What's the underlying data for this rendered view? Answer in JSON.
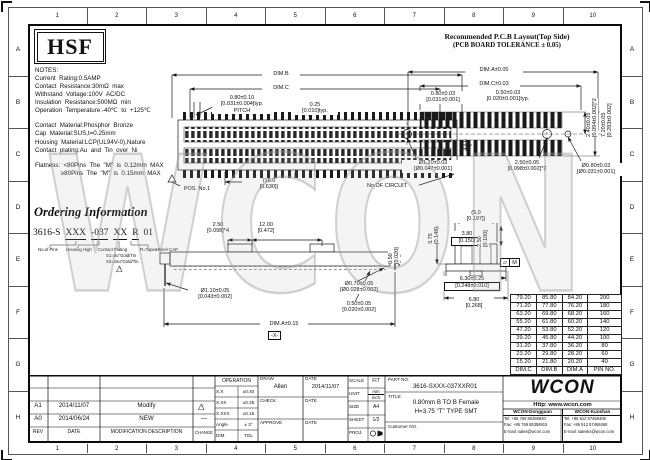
{
  "frame": {
    "cols": [
      "1",
      "2",
      "3",
      "4",
      "5",
      "6",
      "7",
      "8",
      "9",
      "10"
    ],
    "rows": [
      "A",
      "B",
      "C",
      "D",
      "E",
      "F",
      "G",
      "H"
    ]
  },
  "hsf_logo": "HSF",
  "notes": {
    "lines": [
      "NOTES:",
      "Current  Rating:0.5AMP",
      "Contact  Resistance:30mΩ  max",
      "Withstand  Voltage:100V  AC/DC",
      "Insulation  Resistance:500MΩ  min",
      "Operation  Temperature:-40℃  to  +125℃",
      "",
      "Contact  Material:Phosphor  Bronze",
      "Cap  Material:SUS,t=0.25mm",
      "Housing  Material:LCP(UL94V-0),Nature",
      "Contact  plating:Au  and  Tin  over  Ni",
      "",
      "Flatness:  <80Pins  The  \"M\"  is  0.12mm  MAX",
      "               ≥80Pins  The  \"M\"  is  0.15mm  MAX"
    ]
  },
  "pcb": {
    "title": "Recommended P.C.B Layout(Top Side)",
    "subtitle": "(PCB BOARD TOLERANCE ± 0.05)",
    "dim_a": "DIM.A±0.05",
    "dim_c": "DIM.C±0.03",
    "pitch_mm": "0.80±0.03",
    "pitch_in": "[0.031±0.001]",
    "pad_mm": "0.50±0.03",
    "pad_in": "[0.020±0.001]typ.",
    "row_mm": "2.40±0.05",
    "row_in": "[0.094±0.002]*2",
    "span_mm": "7.20±0.05",
    "span_in": "[0.283±0.002]",
    "hole_left_mm": "Ø1.20±0.03",
    "hole_left_in": "[Ø0.047±0.001]",
    "hole_pitch_mm": "2.50±0.05",
    "hole_pitch_in": "[0.098±0.002]*2",
    "hole_right_mm": "Ø0.80±0.03",
    "hole_right_in": "[Ø0.031±0.001]"
  },
  "topview": {
    "dim_b": "DIM.B",
    "dim_c": "DIM.C",
    "pitch_mm": "0.80±0.10",
    "pitch_in": "[0.031±0.004]typ.",
    "pitch_word": "PITCH",
    "tab_mm": "0.25",
    "tab_in": "[0.010]typ.",
    "len_mm": "(16.0",
    "len_in": "[0.630])",
    "pos1": "POS. No.1",
    "circuit": "No.OF CIRCUIT"
  },
  "sideview": {
    "cap_mm": "2.50",
    "cap_in": "[0.098]*4",
    "mid_mm": "12.00",
    "mid_in": "[0.472]",
    "hole_mm": "Ø1.10±0.05",
    "hole_in": "[0.043±0.002]",
    "pin_mm": "Ø0.70±0.05",
    "pin_in": "[Ø0.028±0.002]",
    "h_mm": "0.50",
    "h_in": "[0.020]",
    "foot_mm": "0.50±0.05",
    "foot_in": "[0.020±0.002]",
    "dim_a": "DIM.A±0.15",
    "datum": "-X-"
  },
  "section": {
    "w_mm": "(5.0",
    "w_in": "[0.197])",
    "h_mm": "3.75",
    "h_in": "[0.148]",
    "slot_mm": "3.80",
    "slot_in": "[0.150]",
    "d_mm": "2.50",
    "d_in": "[0.100]",
    "base_mm": "6.30±0.25",
    "base_in": "[0.248±0.010]",
    "ow_mm": "6.80",
    "ow_in": "[0.268]",
    "flat": "M"
  },
  "ordering": {
    "title": "Ordering Information",
    "parts": [
      "3616-S",
      "XXX",
      "-037",
      "XX",
      "R",
      "01"
    ],
    "labels": [
      "No.of Pins",
      "Housing High",
      "Contact Plating",
      "R=Tape&Reel+CAP"
    ],
    "plating_options": [
      "S1=0u\"Gold/Tin",
      "S3=15u\"Gold/Tin"
    ],
    "flag": "1"
  },
  "pin_table": {
    "headers": [
      "DIM.C",
      "DIM.B",
      "DIM.A",
      "PIN NO."
    ],
    "rows": [
      [
        "79.20",
        "85.80",
        "84.20",
        "200"
      ],
      [
        "71.20",
        "77.80",
        "76.20",
        "180"
      ],
      [
        "63.20",
        "69.80",
        "68.20",
        "160"
      ],
      [
        "55.20",
        "61.80",
        "60.20",
        "140"
      ],
      [
        "47.20",
        "53.80",
        "52.20",
        "120"
      ],
      [
        "39.20",
        "45.80",
        "44.20",
        "100"
      ],
      [
        "31.20",
        "37.80",
        "36.20",
        "80"
      ],
      [
        "23.20",
        "29.80",
        "28.20",
        "60"
      ],
      [
        "15.20",
        "21.80",
        "20.20",
        "40"
      ]
    ]
  },
  "titleblock": {
    "revisions": [
      {
        "rev": "A1",
        "date": "2014/11/07",
        "desc": "Modify",
        "change": "1"
      },
      {
        "rev": "A0",
        "date": "2014/06/24",
        "desc": "NEW",
        "change": "—"
      }
    ],
    "headers": {
      "rev": "REV",
      "date": "DATE",
      "desc": "MODIFICATION  DESCRIPTION",
      "change": "CHANGE"
    },
    "operation": {
      "title": "OPERATION",
      "rows": [
        [
          "X.X",
          "±0.40"
        ],
        [
          "X.XX",
          "±0.25"
        ],
        [
          "X.XXX",
          "±0.15"
        ],
        [
          "Angle",
          "± 3°"
        ],
        [
          "DIM",
          "TOL"
        ]
      ]
    },
    "sign": {
      "draw_label": "DRAW",
      "draw_name": "Allen",
      "date_label": "DATE",
      "draw_date": "2014/11/07",
      "check_label": "CHECK",
      "approve_label": "APPROVE"
    },
    "info": {
      "scale_label": "SCALE",
      "scale": "FIT",
      "unit_label": "UNIT",
      "unit_top": "mm",
      "unit_bottom": "inch",
      "size_label": "SIZE",
      "size": "A4",
      "sheet_label": "SHEET",
      "sheet": "1/2",
      "proj_label": "PROJ."
    },
    "part_label": "PART NO.",
    "part_no": "3616-SXXX-037XXR01",
    "title_label": "TITLE:",
    "title_line1": "0.80mm B TO B Female",
    "title_line2": "H=3.75 \"T\" TYPE SMT",
    "customer_label": "Customer NO."
  },
  "company": {
    "logo": "WCON",
    "url": "Http: www.wcon.com",
    "offices": [
      {
        "name": "WCON-Dongguan",
        "tel": "Tel: +86 769 85358920",
        "fax": "Fax: +86 769 85358915",
        "email": "E-mail: sales@wcon.com"
      },
      {
        "name": "WCON-Kunshan",
        "tel": "Tel: +86 512 57468408",
        "fax": "Fax: +86 512 57468468",
        "email": "E-mail: salesks@wcon.com"
      }
    ]
  },
  "watermark": "WCON"
}
